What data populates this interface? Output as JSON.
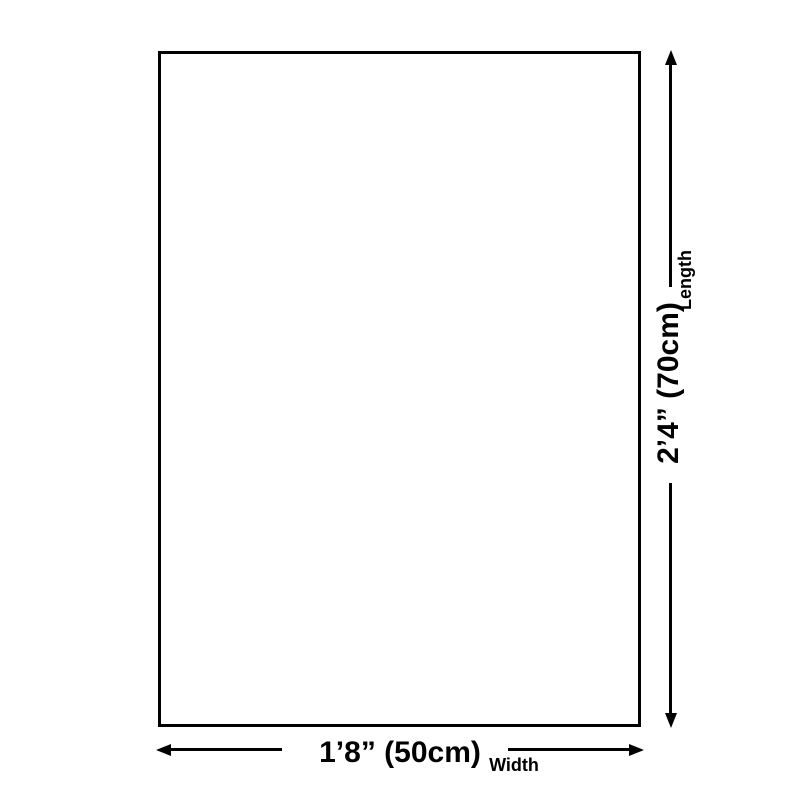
{
  "diagram": {
    "colors": {
      "background": "#ffffff",
      "line": "#000000",
      "text": "#000000",
      "rectangle_fill": "#ffffff",
      "rectangle_border": "#000000"
    },
    "length_dimension": {
      "value": "2’4” (70cm)",
      "axis_label": "Length"
    },
    "width_dimension": {
      "value": "1’8” (50cm)",
      "axis_label": "Width"
    }
  }
}
